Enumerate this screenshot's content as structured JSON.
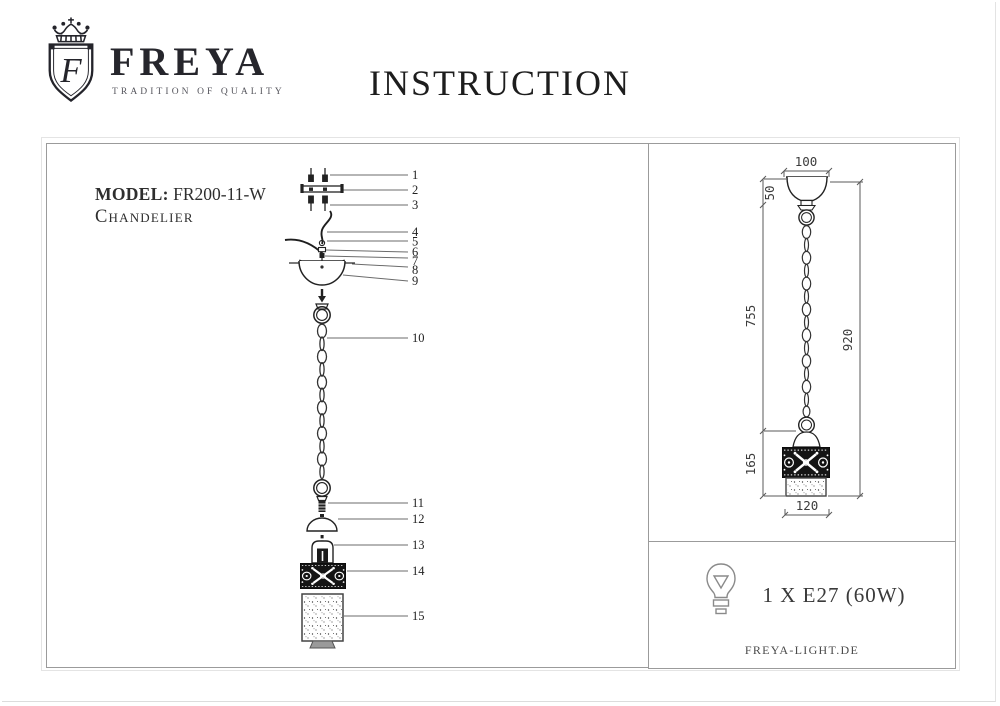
{
  "header": {
    "brand": "FREYA",
    "tagline": "TRADITION OF QUALITY",
    "monogram": "F",
    "title": "INSTRUCTION"
  },
  "model": {
    "label": "MODEL:",
    "number": "FR200-11-W",
    "product": "Chandelier"
  },
  "exploded_view": {
    "part_numbers": [
      "1",
      "2",
      "3",
      "4",
      "5",
      "6",
      "7",
      "8",
      "9",
      "10",
      "11",
      "12",
      "13",
      "14",
      "15"
    ]
  },
  "dimensions_mm": {
    "canopy_width": "100",
    "canopy_height": "50",
    "suspension_length": "755",
    "total_height": "920",
    "shade_height": "165",
    "shade_width": "120"
  },
  "lamp_spec": {
    "bulb": "1 X E27 (60W)"
  },
  "footer": {
    "website": "FREYA-LIGHT.DE"
  },
  "colors": {
    "line": "#444444",
    "panel_border": "#9b9b9b",
    "ink": "#1d1d1d"
  }
}
